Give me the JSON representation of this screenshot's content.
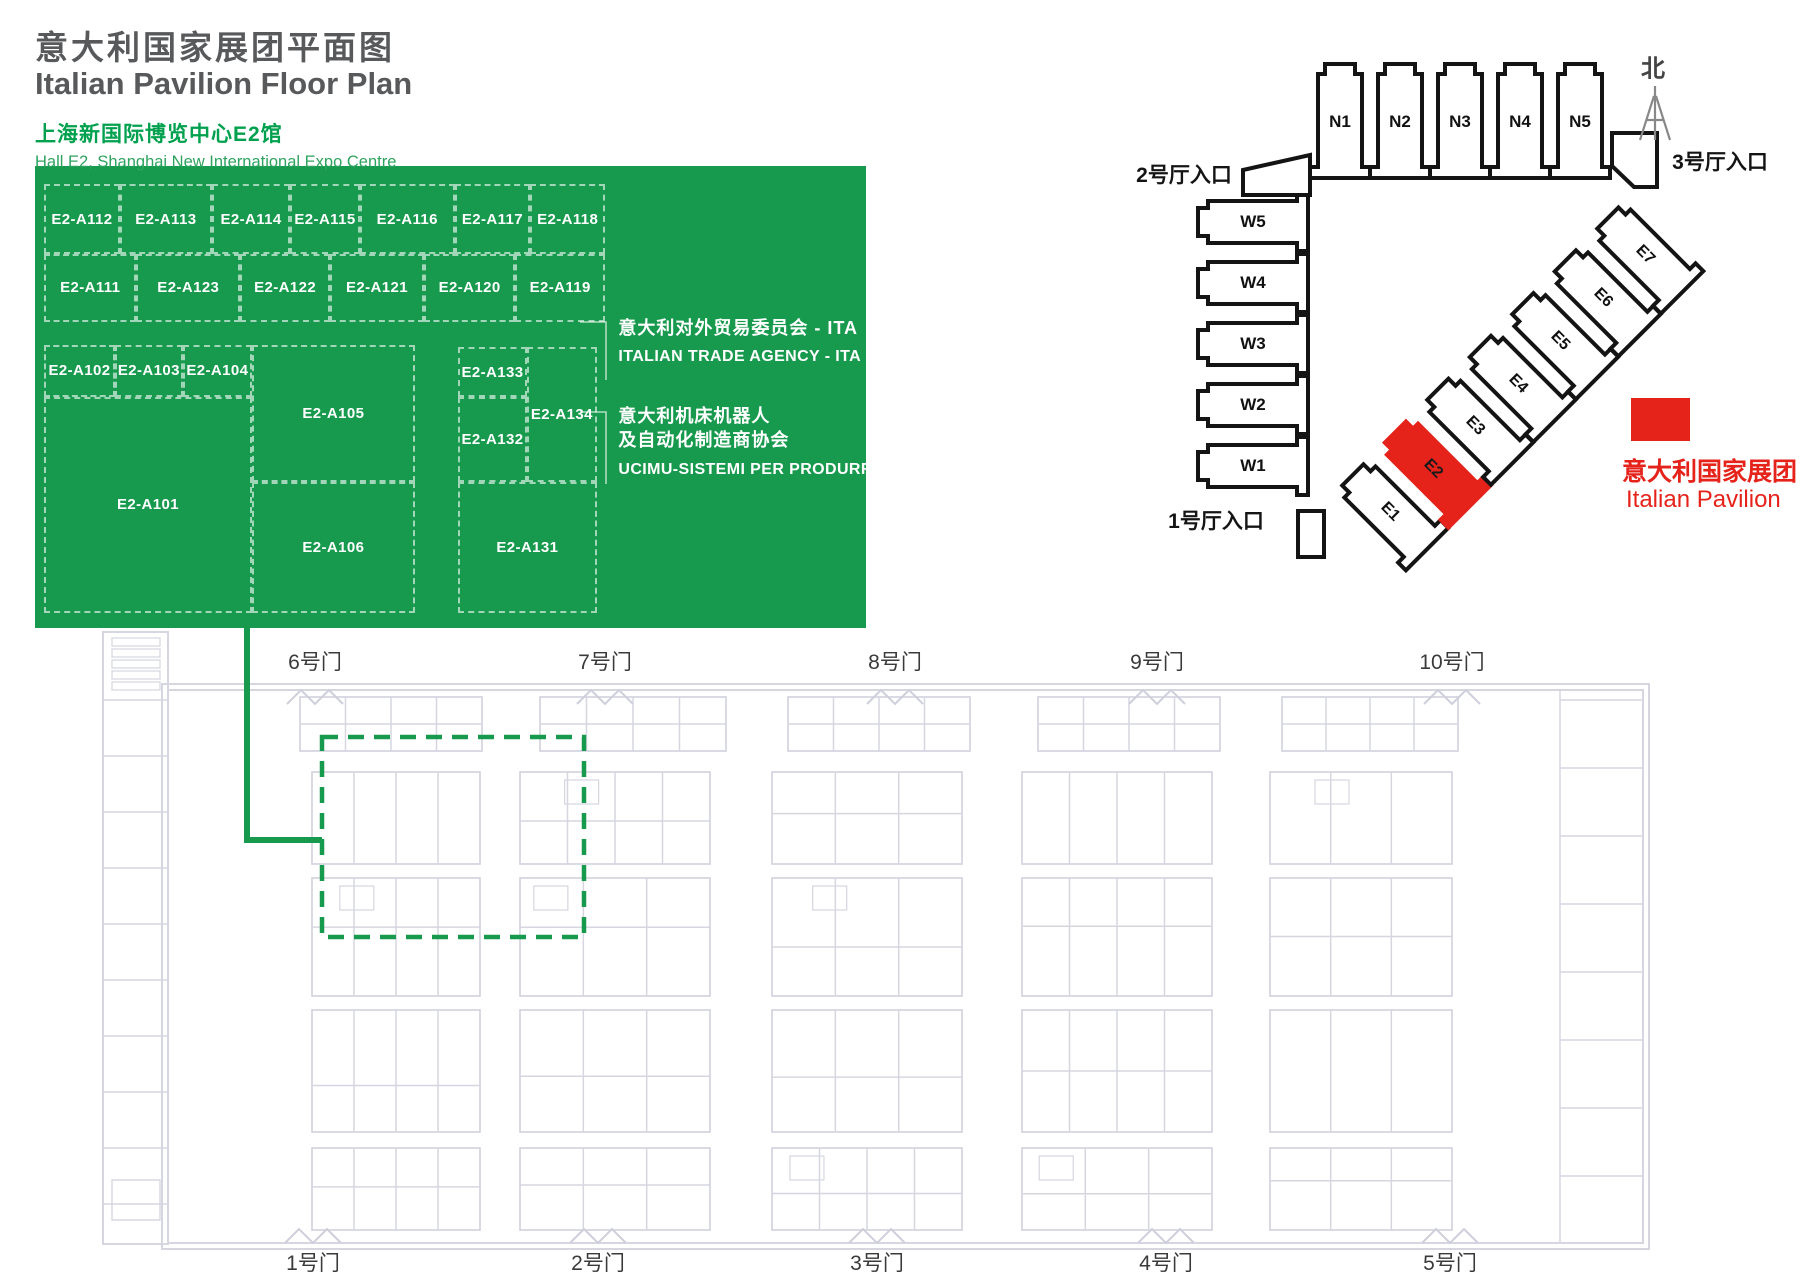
{
  "header": {
    "title_cn": "意大利国家展团平面图",
    "title_en": "Italian Pavilion Floor Plan",
    "subtitle_cn": "上海新国际博览中心E2馆",
    "subtitle_en": "Hall E2, Shanghai New International Expo Centre"
  },
  "pavilion_plan": {
    "booths": [
      {
        "id": "E2-A112",
        "l": 1.1,
        "t": 3.9,
        "w": 9.1,
        "h": 15.2
      },
      {
        "id": "E2-A113",
        "l": 10.2,
        "t": 3.9,
        "w": 11.1,
        "h": 15.2
      },
      {
        "id": "E2-A114",
        "l": 21.3,
        "t": 3.9,
        "w": 9.4,
        "h": 15.2
      },
      {
        "id": "E2-A115",
        "l": 30.7,
        "t": 3.9,
        "w": 8.4,
        "h": 15.2
      },
      {
        "id": "E2-A116",
        "l": 39.1,
        "t": 3.9,
        "w": 11.4,
        "h": 15.2
      },
      {
        "id": "E2-A117",
        "l": 50.5,
        "t": 3.9,
        "w": 9.1,
        "h": 15.2
      },
      {
        "id": "E2-A118",
        "l": 59.6,
        "t": 3.9,
        "w": 9.0,
        "h": 15.2
      },
      {
        "id": "E2-A111",
        "l": 1.1,
        "t": 19.0,
        "w": 11.1,
        "h": 14.7
      },
      {
        "id": "E2-A123",
        "l": 12.2,
        "t": 19.0,
        "w": 12.5,
        "h": 14.7
      },
      {
        "id": "E2-A122",
        "l": 24.7,
        "t": 19.0,
        "w": 10.8,
        "h": 14.7
      },
      {
        "id": "E2-A121",
        "l": 35.5,
        "t": 19.0,
        "w": 11.3,
        "h": 14.7
      },
      {
        "id": "E2-A120",
        "l": 46.8,
        "t": 19.0,
        "w": 11.0,
        "h": 14.7
      },
      {
        "id": "E2-A119",
        "l": 57.8,
        "t": 19.0,
        "w": 10.8,
        "h": 14.7
      },
      {
        "id": "E2-A102",
        "l": 1.1,
        "t": 38.7,
        "w": 8.5,
        "h": 11.3
      },
      {
        "id": "E2-A103",
        "l": 9.6,
        "t": 38.7,
        "w": 8.2,
        "h": 11.3
      },
      {
        "id": "E2-A104",
        "l": 17.8,
        "t": 38.7,
        "w": 8.3,
        "h": 11.3
      },
      {
        "id": "E2-A101",
        "l": 1.1,
        "t": 50.0,
        "w": 25.0,
        "h": 46.7
      },
      {
        "id": "E2-A105",
        "l": 26.1,
        "t": 38.7,
        "w": 19.6,
        "h": 29.6
      },
      {
        "id": "E2-A106",
        "l": 26.1,
        "t": 68.4,
        "w": 19.6,
        "h": 28.3
      },
      {
        "id": "E2-A133",
        "l": 50.9,
        "t": 39.2,
        "w": 8.3,
        "h": 10.8
      },
      {
        "id": "E2-A132",
        "l": 50.9,
        "t": 50.0,
        "w": 8.3,
        "h": 18.4
      },
      {
        "id": "E2-A134",
        "l": 59.2,
        "t": 39.2,
        "w": 8.4,
        "h": 29.2
      },
      {
        "id": "E2-A131",
        "l": 50.9,
        "t": 68.4,
        "w": 16.7,
        "h": 28.3
      }
    ],
    "annotations": [
      {
        "cn1": "意大利对外贸易委员会 - ITA",
        "cn2": "",
        "en": "ITALIAN TRADE AGENCY - ITA"
      },
      {
        "cn1": "意大利机床机器人",
        "cn2": "及自动化制造商协会",
        "en": "UCIMU-SISTEMI PER PRODURRE"
      }
    ]
  },
  "site_map": {
    "north_label": "北",
    "north_halls": [
      "N1",
      "N2",
      "N3",
      "N4",
      "N5"
    ],
    "west_halls": [
      "W5",
      "W4",
      "W3",
      "W2",
      "W1"
    ],
    "east_halls": [
      "E1",
      "E2",
      "E3",
      "E4",
      "E5",
      "E6",
      "E7"
    ],
    "highlighted_hall": "E2",
    "entrances": {
      "hall1": "1号厅入口",
      "hall2": "2号厅入口",
      "hall3": "3号厅入口"
    },
    "legend": {
      "label_cn": "意大利国家展团",
      "label_en": "Italian Pavilion"
    }
  },
  "hall_plan": {
    "top_gates": [
      "6号门",
      "7号门",
      "8号门",
      "9号门",
      "10号门"
    ],
    "bottom_gates": [
      "1号门",
      "2号门",
      "3号门",
      "4号门",
      "5号门"
    ]
  },
  "colors": {
    "green": "#179a4d",
    "heading_green": "#00a14e",
    "red": "#e5231b",
    "title_gray": "#58595b",
    "map_ink": "#141414",
    "faint": "#d6d6e1",
    "faint2": "#cfcfdc"
  }
}
